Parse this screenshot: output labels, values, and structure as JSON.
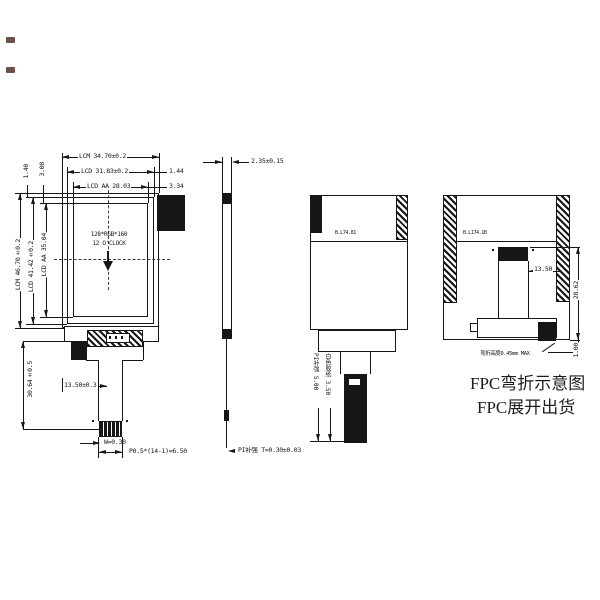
{
  "front_view": {
    "top_dims": {
      "lcm_width": "LCM 34.70±0.2",
      "lcd_width": "LCD 31.83±0.2",
      "lcd_right_gap": "1.44",
      "aa_width": "LCD AA 28.03",
      "aa_right_gap": "3.34"
    },
    "left_dims": {
      "lcd_top_gap": "1.40",
      "aa_top_gap": "3.00",
      "aa_height": "LCD AA 35.04",
      "lcd_height": "LCD 41.42±0.2",
      "lcm_height": "LCM 46.70±0.2",
      "fpc_length": "30.64±0.5"
    },
    "display": {
      "resolution": "128*RGB*160",
      "viewing_direction": "12 O'CLOCK"
    },
    "bottom_dims": {
      "ic_offset": "13.50±0.3",
      "pad_width": "W=0.30",
      "pad_pitch": "P0.5*(14-1)=6.50"
    }
  },
  "side_view": {
    "thickness": "2.35±0.15",
    "stiffener_note": "PI补强 T=0.30±0.03"
  },
  "unfolded_view": {
    "backlight_label": "B.L74.81",
    "stiffener": "PI补强 5.00",
    "tape": "白色胶纸 3.50"
  },
  "folded_view": {
    "backlight_label": "B.L174.1B",
    "fpc_offset": "13.50",
    "fold_height": "28.62",
    "bottom_gap": "1.00",
    "bend_note": "弯折高度0.45mm MAX"
  },
  "captions": {
    "fold_title": "FPC弯折示意图",
    "ship_title": "FPC展开出货"
  }
}
